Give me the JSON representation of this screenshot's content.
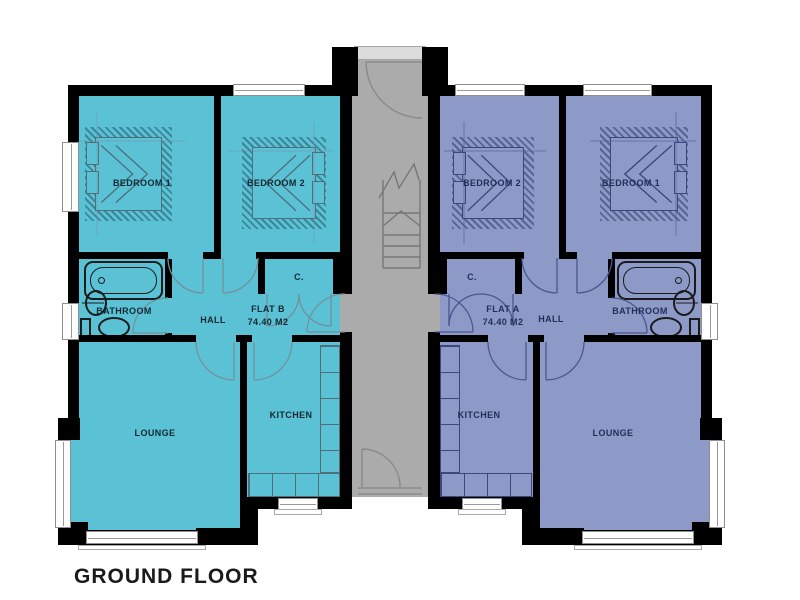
{
  "title": "GROUND FLOOR",
  "colors": {
    "flat_b_fill": "#5BC2D6",
    "flat_a_fill": "#8D99C7",
    "stairwell_fill": "#ABABAB",
    "wall": "#000000"
  },
  "flat_b": {
    "name": "FLAT B",
    "area": "74.40 M2",
    "bedroom1": "BEDROOM 1",
    "bedroom2": "BEDROOM 2",
    "bathroom": "BATHROOM",
    "hall": "HALL",
    "cupboard": "C.",
    "lounge": "LOUNGE",
    "kitchen": "KITCHEN"
  },
  "flat_a": {
    "name": "FLAT A",
    "area": "74.40 M2",
    "bedroom1": "BEDROOM 1",
    "bedroom2": "BEDROOM 2",
    "bathroom": "BATHROOM",
    "hall": "HALL",
    "cupboard": "C.",
    "lounge": "LOUNGE",
    "kitchen": "KITCHEN"
  }
}
